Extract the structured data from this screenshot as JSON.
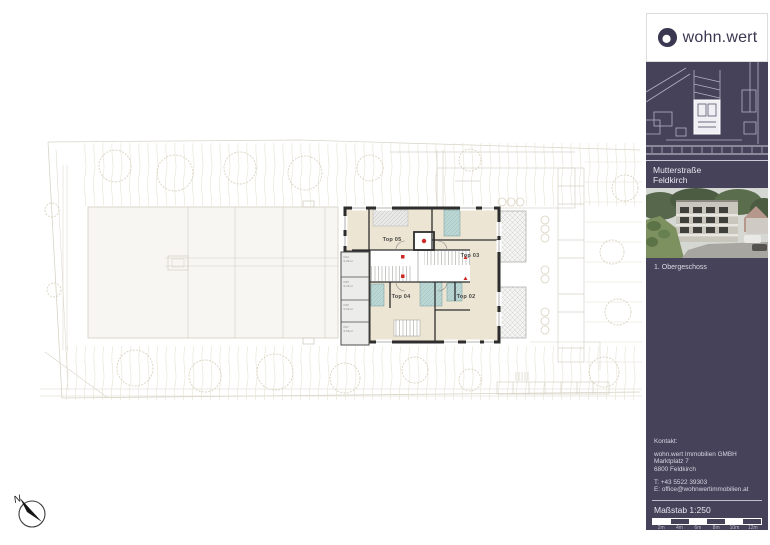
{
  "sidebar": {
    "logo": {
      "text": "wohn.wert"
    },
    "project": {
      "street": "Mutterstraße",
      "city": "Feldkirch"
    },
    "floor_label": "1. Obergeschoss",
    "contact": {
      "heading": "Kontakt:",
      "lines": [
        "wohn.wert Immobilien GMBH",
        "Marktplatz 7",
        "6800 Feldkirch"
      ],
      "phone": "T: +43 5522 39303",
      "email": "E: office@wohnwertimmobilien.at"
    },
    "scale": {
      "label": "Maßstab 1:250",
      "ticks": [
        "2m",
        "4m",
        "6m",
        "8m",
        "10m",
        "12m"
      ]
    }
  },
  "plan": {
    "units": [
      {
        "label": "Top 05"
      },
      {
        "label": "Top 03"
      },
      {
        "label": "Top 04"
      },
      {
        "label": "Top 02"
      }
    ],
    "storage_rooms": [
      {
        "id": "K04",
        "area": "6,01m²"
      },
      {
        "id": "K05",
        "area": "5,01m²"
      },
      {
        "id": "K06",
        "area": "6,01m²"
      },
      {
        "id": "K07",
        "area": "6,51m²"
      }
    ],
    "compass": "N"
  },
  "colors": {
    "sidebar_navy": "#454259",
    "room_beige": "#ede5d3",
    "bath_teal": "#bcd6d4",
    "wall": "#2d2d2d",
    "marker_red": "#cd2a26",
    "site_line": "#ddd9cb"
  }
}
